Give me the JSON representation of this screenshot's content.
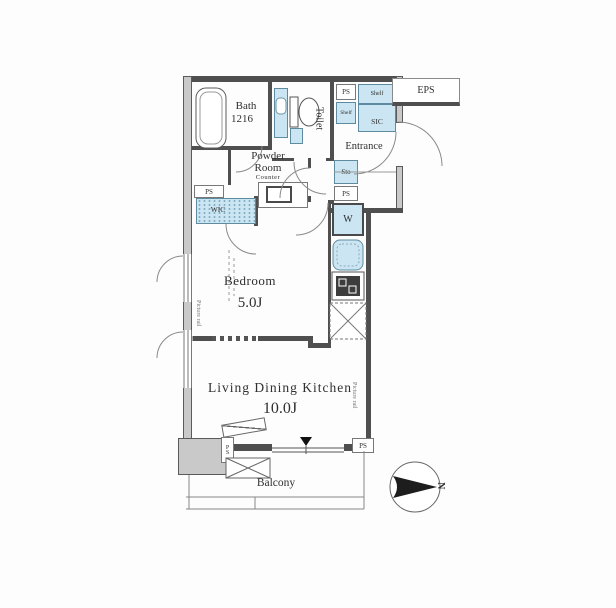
{
  "plan": {
    "rooms": {
      "bath": {
        "name": "Bath",
        "size": "1216"
      },
      "powder": {
        "line1": "Powder",
        "line2": "Room",
        "counter": "Counter"
      },
      "toilet": {
        "name": "Toilet"
      },
      "entrance": {
        "name": "Entrance"
      },
      "sic": {
        "name": "SIC"
      },
      "eps": {
        "name": "EPS"
      },
      "wic": {
        "name": "WIC"
      },
      "bedroom": {
        "name": "Bedroom",
        "size": "5.0J"
      },
      "ldk": {
        "name": "Living Dining Kitchen",
        "size": "10.0J"
      },
      "balcony": {
        "name": "Balcony"
      }
    },
    "fixtures": {
      "shelf": "Shelf",
      "storage": "Sto",
      "pipe_space": "PS",
      "washer": "W",
      "picture_rail": "Picture rail"
    },
    "compass": {
      "north": "N"
    },
    "colors": {
      "fixture_blue": "#cbe6f2",
      "wall_dark": "#4f4f4f",
      "wall_gray": "#c9c9c9"
    }
  }
}
